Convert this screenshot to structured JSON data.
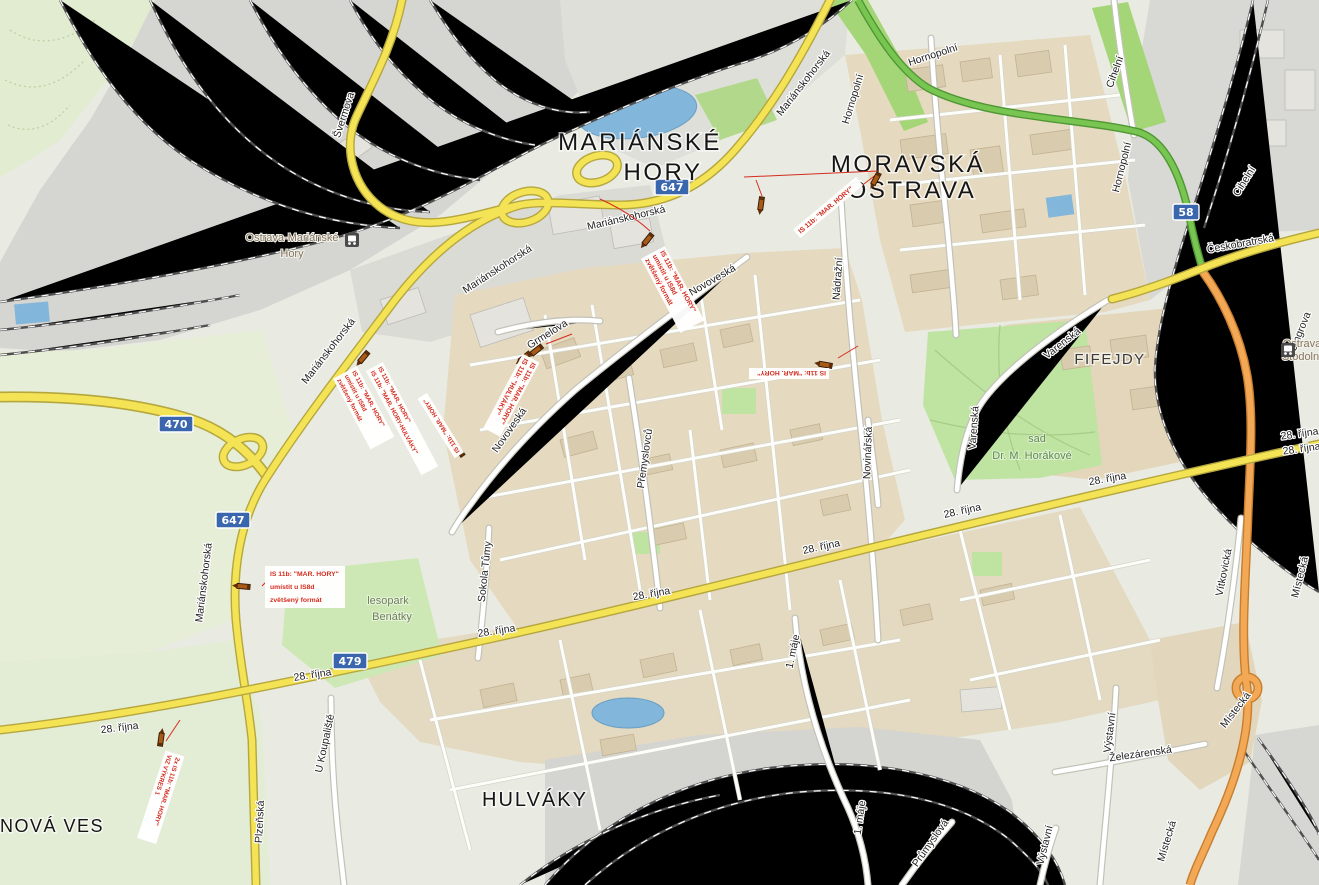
{
  "colors": {
    "annotation_red": "#d42b1f",
    "road_yellow": "#f4e354",
    "road_orange": "#f2a855",
    "road_green": "#79c551",
    "water_blue": "#82b6db",
    "park_green": "#bfe3a1",
    "shield_blue": "#3a66ad"
  },
  "districts": {
    "marianske_hory_1": "MARIÁNSKÉ",
    "marianske_hory_2": "HORY",
    "moravska_1": "MORAVSKÁ",
    "moravska_2": "OSTRAVA",
    "hulvaky": "HULVÁKY",
    "nova_ves": "NOVÁ VES",
    "fifejdy": "FIFEJDY"
  },
  "places": {
    "station_mh_1": "Ostrava-Mariánské",
    "station_mh_2": "Hory",
    "station_st_1": "Ostrava",
    "station_st_2": "Stodolní",
    "lesopark_1": "lesopark",
    "lesopark_2": "Benátky",
    "sad_1": "sad",
    "sad_2": "Dr. M. Horákové"
  },
  "streets": [
    "Švermova",
    "Mariánskohorská",
    "Mariánskohorská",
    "Mariánskohorská",
    "Mariánskohorská",
    "Mariánskohorská",
    "Hornopolní",
    "Hornopolní",
    "Hornopolní",
    "Cihelní",
    "Cihelní",
    "Českobratrská",
    "Cingrova",
    "Nádražní",
    "Novinářská",
    "Varenská",
    "Varenská",
    "Novoveská",
    "Novoveská",
    "Přemyslovců",
    "Sokola Tůmy",
    "Grmelova",
    "U Koupaliště",
    "Plzeňská",
    "28. října",
    "28. října",
    "28. října",
    "28. října",
    "28. října",
    "28. října",
    "28. října",
    "28. října",
    "28. října",
    "1. máje",
    "1. máje",
    "Železárenská",
    "Průmyslová",
    "Výstavní",
    "Výstavní",
    "Vítkovická",
    "Místecká",
    "Místecká",
    "Místecká"
  ],
  "shields": {
    "s647": "647",
    "s470": "470",
    "s479": "479",
    "s58": "58"
  },
  "annotations": {
    "a1": [
      "IS 11b: \"MAR. HORY\"",
      "umístit u IS8d",
      "zvětšený formát"
    ],
    "a2": [
      "IS 11b: \"MAR. HORY\""
    ],
    "a4": [
      "IS 11b: \"MAR. HORY\"",
      "IS 11b: \"HULVÁKY\""
    ],
    "a5a": [
      "IS 11b: \"MAR. HORY\"",
      "umístit u IS8d",
      "zvětšený formát"
    ],
    "a5b": [
      "IS 11b: \"MAR. HORY\"",
      "IS 11b: \"MAR. HORY-HULVÁKY\""
    ],
    "a6": [
      "IS 11b: \"MAR. HORY\""
    ],
    "a7": [
      "IS 11b: \"MAR. HORY\""
    ],
    "a8": [
      "IS 11b: \"MAR. HORY\"",
      "umístit u IS8d",
      "zvětšený formát"
    ],
    "a9": [
      "2x IS 11b: \"MAR. HORY\"",
      "VIZ VÝKRES 1"
    ]
  }
}
